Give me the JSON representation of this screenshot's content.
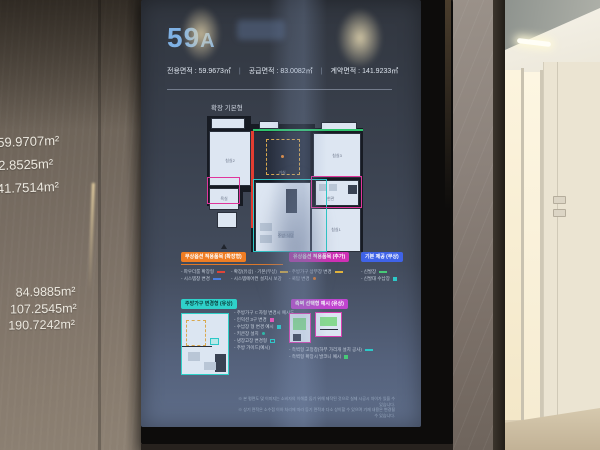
{
  "left_wall_sign": {
    "areas_top": [
      "59.9707m²",
      "82.8525m²",
      "41.7514m²"
    ],
    "areas_bottom": [
      "84.9885m²",
      "107.2545m²",
      "190.7242m²"
    ]
  },
  "screen": {
    "unit_number": "59",
    "unit_letter": "A",
    "area_row": {
      "exclusive": "전용면적 : 59.9673㎡",
      "divider": "|",
      "supply": "공급면적 : 83.0082㎡",
      "contract": "계약면적 : 141.9233㎡"
    },
    "plan_type_label": "확장 기본형",
    "floor_plan": {
      "label_bed2": "침실2",
      "label_living": "거실",
      "label_bed3": "침실3",
      "label_bath": "욕실",
      "label_entry": "현관",
      "label_kitchen": "주방·식당",
      "label_bed1": "침실1"
    },
    "legend_sections": [
      {
        "title": "무상옵션 적용품목 (확장형)",
        "columns": [
          [
            {
              "text": "- 파우더룸 확장형"
            },
            {
              "text": "- 시스템창 변경"
            }
          ],
          [
            {
              "text": "- 확장(유상) · 기본(무상)"
            },
            {
              "text": "- 시스템에어컨 설치시 보강"
            }
          ]
        ]
      },
      {
        "title": "유상옵션 적용품목 (추가)",
        "items": [
          {
            "text": "- 주방가구 상부장 변경"
          },
          {
            "text": "- 쿡탑 변경"
          }
        ]
      },
      {
        "title": "기본 제공 (무상)",
        "items": [
          {
            "text": "- 신발장"
          },
          {
            "text": "- 신발대 수납장"
          }
        ]
      }
    ],
    "kitchen_detail": {
      "title": "주방가구 변경형 (유상)",
      "items": [
        {
          "text": "- 주방가구 ㄷ자형 변경시 예시도"
        },
        {
          "text": "- 인덕션 3구 변경"
        },
        {
          "text": "- 수납장 형 변경 예시"
        },
        {
          "text": "- 키큰장 설치"
        },
        {
          "text": "- 냉장고장 변경형"
        },
        {
          "text": "- 주방 가이드(예시)"
        }
      ]
    },
    "side_option": {
      "title": "측벽 선택형 예시 (유상)",
      "items": [
        {
          "text": "- 측벽형 고정창(하부 가리개 설치 공사)"
        },
        {
          "text": "- 측벽형 확장시 발코니 예시"
        }
      ]
    },
    "footnotes": [
      "※ 본 평면도 및 이미지는 소비자의 이해를 돕기 위해 제작된 것으로 실제 시공시 차이가 있을 수 있습니다.",
      "※ 상기 면적은 소수점 이하 처리에 따라 등기 면적과 다소 상이할 수 있으며 기재 내용은 변경될 수 있습니다."
    ]
  },
  "colors": {
    "title_blue": "#7fb1e4",
    "badge_free": "#ef7d23",
    "badge_paid": "#cf2fb5",
    "badge_basic": "#3f63e8",
    "badge_kitchen": "#2fd1c9",
    "badge_side": "#c044cf",
    "outline_red": "#e23d31",
    "outline_green": "#2fc46e",
    "outline_cyan": "#2cc8c8",
    "outline_magenta": "#e0359c",
    "dashed_yellow": "#d9a84e"
  }
}
